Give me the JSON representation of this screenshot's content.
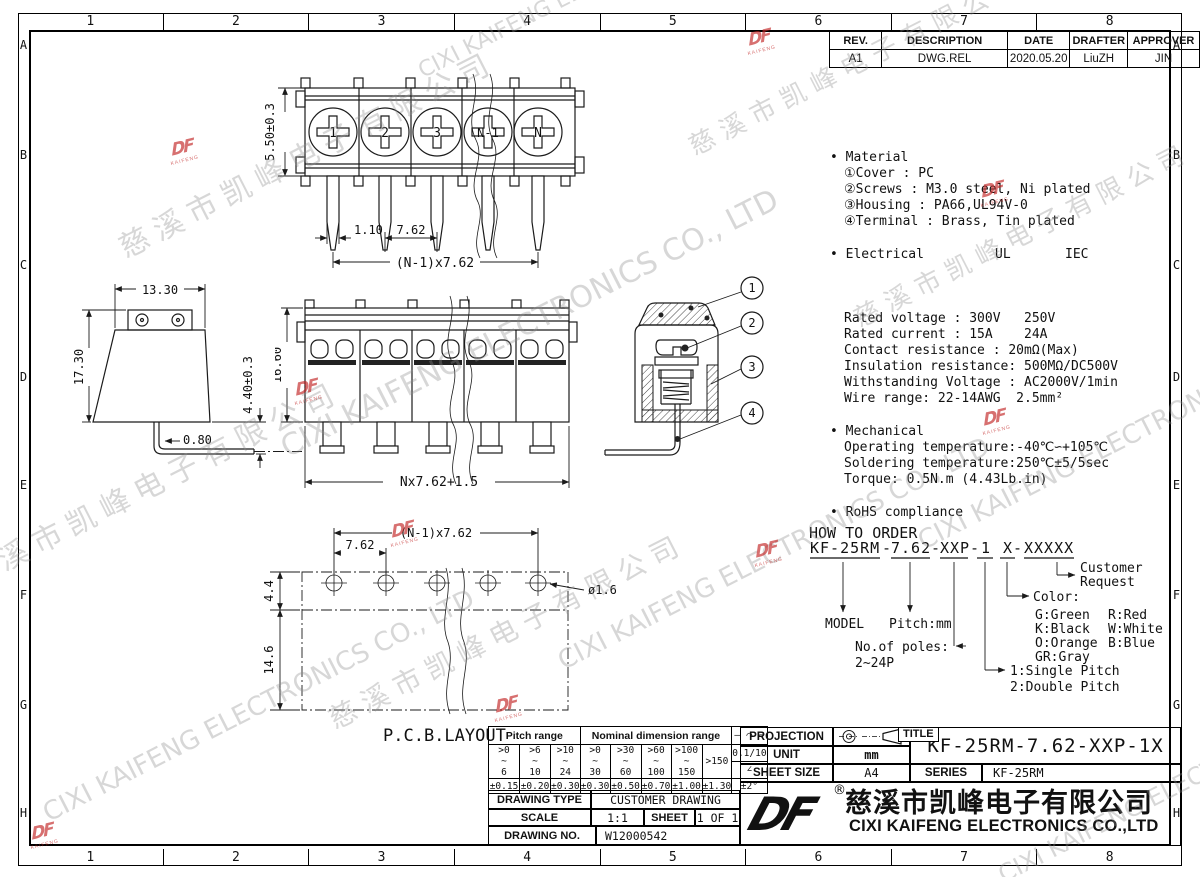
{
  "sheet": {
    "cols": [
      "1",
      "2",
      "3",
      "4",
      "5",
      "6",
      "7",
      "8"
    ],
    "rows": [
      "A",
      "B",
      "C",
      "D",
      "E",
      "F",
      "G",
      "H"
    ]
  },
  "watermark": {
    "cn": "慈溪市凯峰电子有限公司",
    "en": "CIXI KAIFENG ELECTRONICS CO., LTD",
    "logo_df": "DF",
    "logo_sub": "KAIFENG"
  },
  "revision": {
    "headers": [
      "REV.",
      "DESCRIPTION",
      "DATE",
      "DRAFTER",
      "APPROVER"
    ],
    "row": [
      "A1",
      "DWG.REL",
      "2020.05.20",
      "LiuZH",
      "JIN"
    ]
  },
  "specs": {
    "bullet": "•",
    "material_title": "Material",
    "material": [
      "①Cover : PC",
      "②Screws : M3.0 steel, Ni plated",
      "③Housing : PA66,UL94V-0",
      "④Terminal : Brass, Tin plated"
    ],
    "electrical_title": "Electrical",
    "ul": "UL",
    "iec": "IEC",
    "electrical": [
      "Rated voltage : 300V   250V",
      "Rated current : 15A    24A",
      "Contact resistance : 20mΩ(Max)",
      "Insulation resistance: 500MΩ/DC500V",
      "Withstanding Voltage : AC2000V/1min",
      "Wire range: 22-14AWG  2.5mm²"
    ],
    "mechanical_title": "Mechanical",
    "mechanical": [
      "Operating temperature:-40℃∽+105℃",
      "Soldering temperature:250℃±5/5sec",
      "Torque: 0.5N.m (4.43Lb.in)"
    ],
    "rohs_title": "RoHS compliance"
  },
  "order": {
    "title": "HOW TO ORDER",
    "dash": "-",
    "p0": "KF-25RM",
    "p1": "7.62",
    "p2": "XXP",
    "p3": "1",
    "p4": "X",
    "p5": "XXXXX",
    "model": "MODEL",
    "pitch": "Pitch:mm",
    "poles1": "No.of poles:",
    "poles2": "2~24P",
    "pitch_type1": "1:Single Pitch",
    "pitch_type2": "2:Double Pitch",
    "color_label": "Color:",
    "c0": "G:Green",
    "c1": "R:Red",
    "c2": "K:Black",
    "c3": "W:White",
    "c4": "O:Orange",
    "c5": "B:Blue",
    "c6": "GR:Gray",
    "cust1": "Customer",
    "cust2": "Request"
  },
  "tol": {
    "pitch_header": "Pitch range",
    "nominal_header": "Nominal dimension range",
    "symbols": "— ⌒ ▱",
    "ranges": [
      ">0\n~\n6",
      ">6\n~\n10",
      ">10\n~\n24",
      ">0\n~\n30",
      ">30\n~\n60",
      ">60\n~\n100",
      ">100\n~\n150",
      ">150"
    ],
    "flat": "0.1/10",
    "angle": "∠",
    "tols": [
      "±0.15",
      "±0.20",
      "±0.30",
      "±0.30",
      "±0.50",
      "±0.70",
      "±1.00",
      "±1.30"
    ],
    "angle_tol": "±2°"
  },
  "info": {
    "drawing_type_label": "DRAWING TYPE",
    "drawing_type": "CUSTOMER DRAWING",
    "scale_label": "SCALE",
    "scale": "1:1",
    "sheet_label": "SHEET",
    "sheet": "1 OF 1",
    "drawing_no_label": "DRAWING NO.",
    "drawing_no": "W12000542"
  },
  "tb": {
    "projection_label": "PROJECTION",
    "unit_label": "UNIT",
    "unit": "mm",
    "sheet_size_label": "SHEET SIZE",
    "sheet_size": "A4",
    "title_label": "TITLE",
    "title": "KF-25RM-7.62-XXP-1X",
    "series_label": "SERIES",
    "series": "KF-25RM",
    "reg": "®",
    "company_cn": "慈溪市凯峰电子有限公司",
    "company_en": "CIXI KAIFENG ELECTRONICS CO.,LTD",
    "logo": "DF"
  },
  "views": {
    "top": {
      "dim_height": "5.50±0.3",
      "dim_offset": "1.10",
      "dim_pitch": "7.62",
      "dim_span": "(N-1)x7.62",
      "screws": [
        "1",
        "2",
        "3",
        "N-1",
        "N"
      ]
    },
    "side": {
      "dim_width": "13.30",
      "dim_height": "17.30",
      "dim_pin": "0.80",
      "dim_pin_len": "4.40±0.3"
    },
    "front": {
      "dim_height": "16.60",
      "dim_span": "Nx7.62+1.5"
    },
    "section": {
      "callouts": [
        "1",
        "2",
        "3",
        "4"
      ]
    },
    "pcb": {
      "dim_span": "(N-1)x7.62",
      "dim_pitch": "7.62",
      "dim_row": "4.4",
      "dim_depth": "14.6",
      "hole": "ø1.6",
      "caption": "P.C.B.LAYOUT"
    }
  }
}
